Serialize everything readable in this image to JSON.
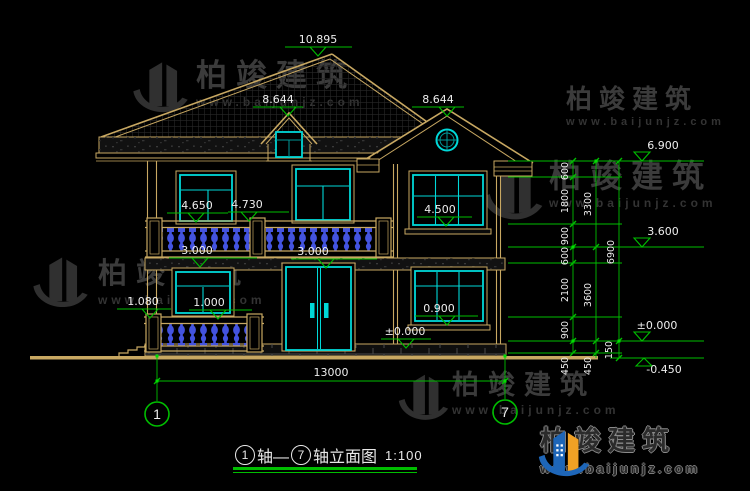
{
  "brand": {
    "name": "柏竣建筑",
    "url": "www.baijunjz.com"
  },
  "title": {
    "axis1": "1",
    "mid": "轴—",
    "axis2": "7",
    "suffix": "轴立面图",
    "scale": "1:100"
  },
  "axis": {
    "left": "1",
    "right": "7",
    "width": "13000"
  },
  "markers": {
    "ridge": "10.895",
    "dormer": "8.644",
    "gable": "8.644",
    "balcony_door": "4.650",
    "balcony_rail": "4.730",
    "win2": "4.500",
    "floor2_a": "3.000",
    "floor2_b": "3.000",
    "porch_sill": "1.080",
    "porch_rail": "1.000",
    "win1_sill": "0.900",
    "ground_left": "±0.000",
    "eave": "6.900",
    "r3600": "3.600",
    "r0": "±0.000",
    "rneg": "-0.450"
  },
  "dims": {
    "col1": [
      "600",
      "1800",
      "900",
      "600",
      "2100",
      "900",
      "450"
    ],
    "col2": [
      "3300",
      "3600",
      "450"
    ],
    "col3": [
      "6900",
      "150"
    ]
  },
  "colors": {
    "line": "#C8A862",
    "glass": "#00D8D8",
    "dim": "#00BE00",
    "baluster": "#4353DF",
    "text": "#EDEDED"
  }
}
